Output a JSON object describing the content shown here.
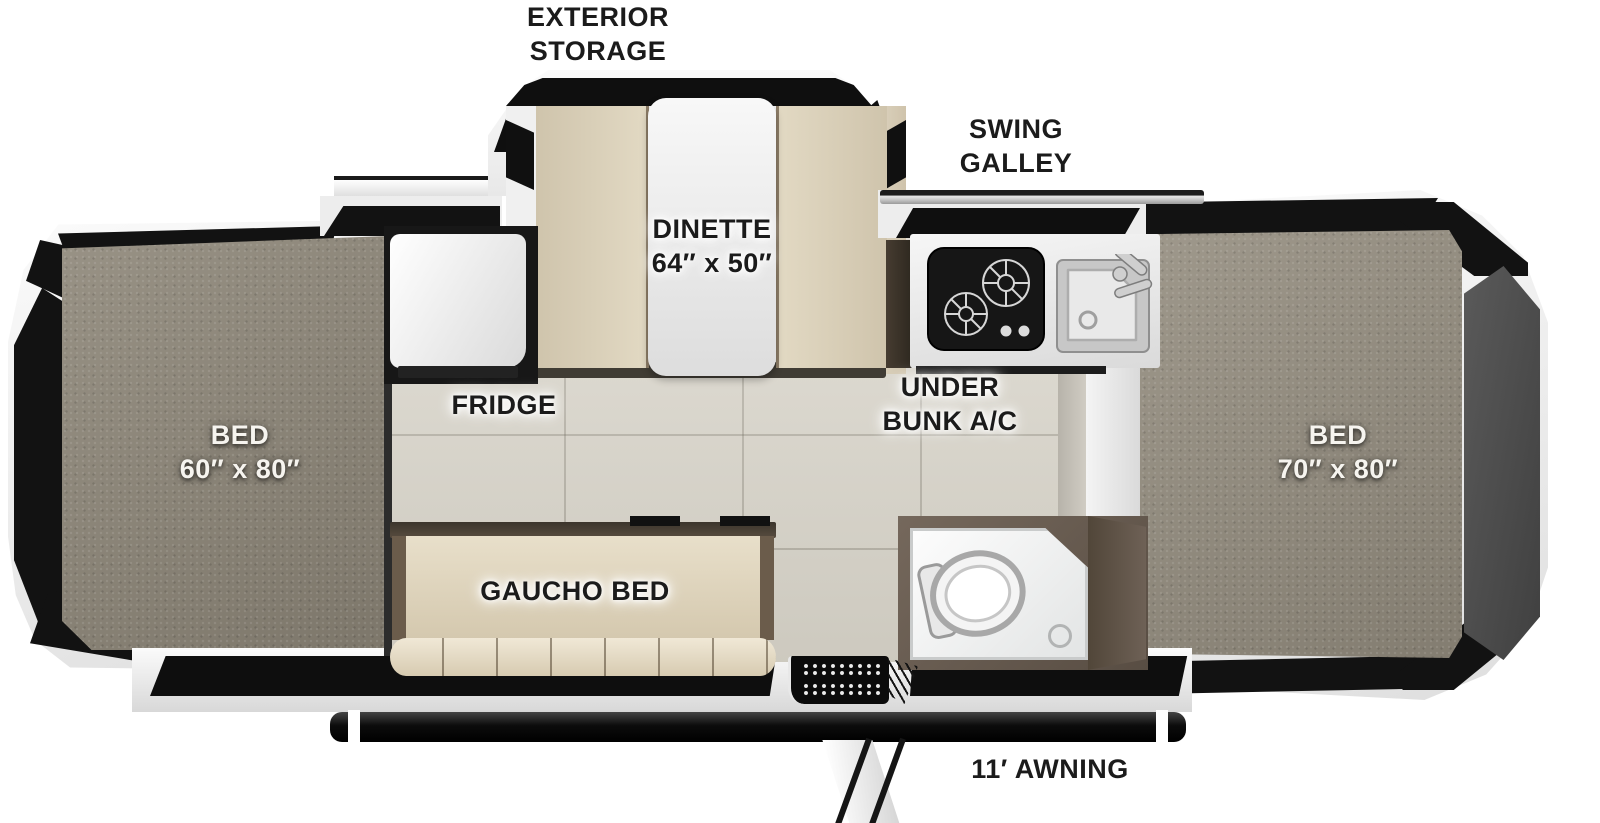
{
  "diagram": {
    "type": "popup-camper-floorplan",
    "labels": {
      "exterior_storage": {
        "l1": "EXTERIOR",
        "l2": "STORAGE"
      },
      "swing_galley": {
        "l1": "SWING",
        "l2": "GALLEY"
      },
      "dinette": {
        "l1": "DINETTE",
        "l2": "64″ x 50″"
      },
      "fridge": "FRIDGE",
      "under_bunk_ac": {
        "l1": "UNDER",
        "l2": "BUNK A/C"
      },
      "bed_left": {
        "l1": "BED",
        "l2": "60″ x 80″"
      },
      "bed_right": {
        "l1": "BED",
        "l2": "70″ x 80″"
      },
      "gaucho_bed": "GAUCHO BED",
      "awning": "11′ AWNING"
    },
    "palette": {
      "body_white": "#f2f2f2",
      "accent_black": "#121212",
      "carpet_gray": "#8e8779",
      "floor_tile": "#dad6cb",
      "cushion_beige": "#ddd3bb",
      "cabinet_brown": "#6a5d52",
      "end_panel_gray": "#4e4e4e"
    }
  }
}
